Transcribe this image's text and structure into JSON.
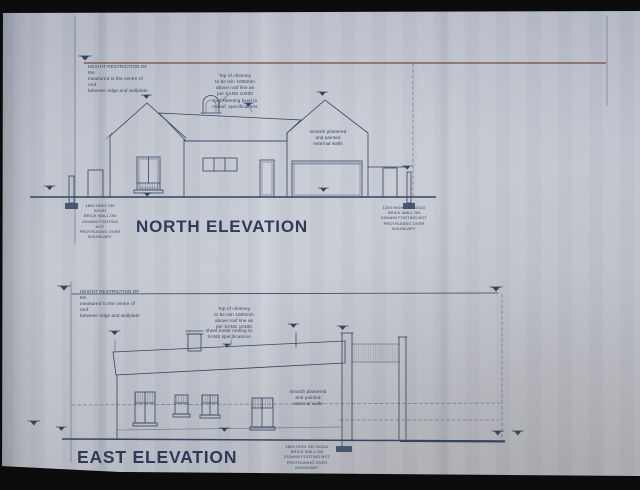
{
  "colors": {
    "paper": "#bfc4ce",
    "line": "#35445f",
    "datum_red": "#7c4743",
    "title": "#24314f",
    "photo_black": "#0c0c0d"
  },
  "north_elevation": {
    "title": "NORTH ELEVATION",
    "notes": {
      "height_restriction": "HEIGHT RESTRICTION OF 8m\nmeasured to the centre of roof\nbetween ridge and wallplate",
      "chimney": "Top of chimney\nto be min 1000mm\nabove roof line as\nper SANS 10400",
      "roof_sheeting": "roof sheeting fixed to\nmanuf. specifications",
      "external_walls": "smooth plastered\nand painted\nexternal walls",
      "left_boundary_wall": "1800 HIGH 230 SOLID\nBRICK WALL ON\n230x690 FOOTING NOT\nPROTRUDING OVER\nBOUNDARY",
      "right_boundary_wall": "1200 HIGH 230 SOLID\nBRICK WALL ON\n230x690 FOOTING NOT\nPROTRUDING OVER\nBOUNDARY"
    }
  },
  "east_elevation": {
    "title": "EAST ELEVATION",
    "notes": {
      "height_restriction": "HEIGHT RESTRICTION OF 8m\nmeasured to the centre of roof\nbetween ridge and wallplate",
      "chimney": "Top of chimney\nto be min 1000mm\nabove roof line as\nper SANS 10400",
      "roof_sheeting": "sheet metal roofing to\nSANS specifications",
      "external_walls": "smooth plastered\nand painted\nexternal walls",
      "boundary_wall": "1800 HIGH 230 SOLID\nBRICK WALL ON\n230x690 FOOTING NOT\nPROTRUDING OVER\nBOUNDARY"
    }
  }
}
